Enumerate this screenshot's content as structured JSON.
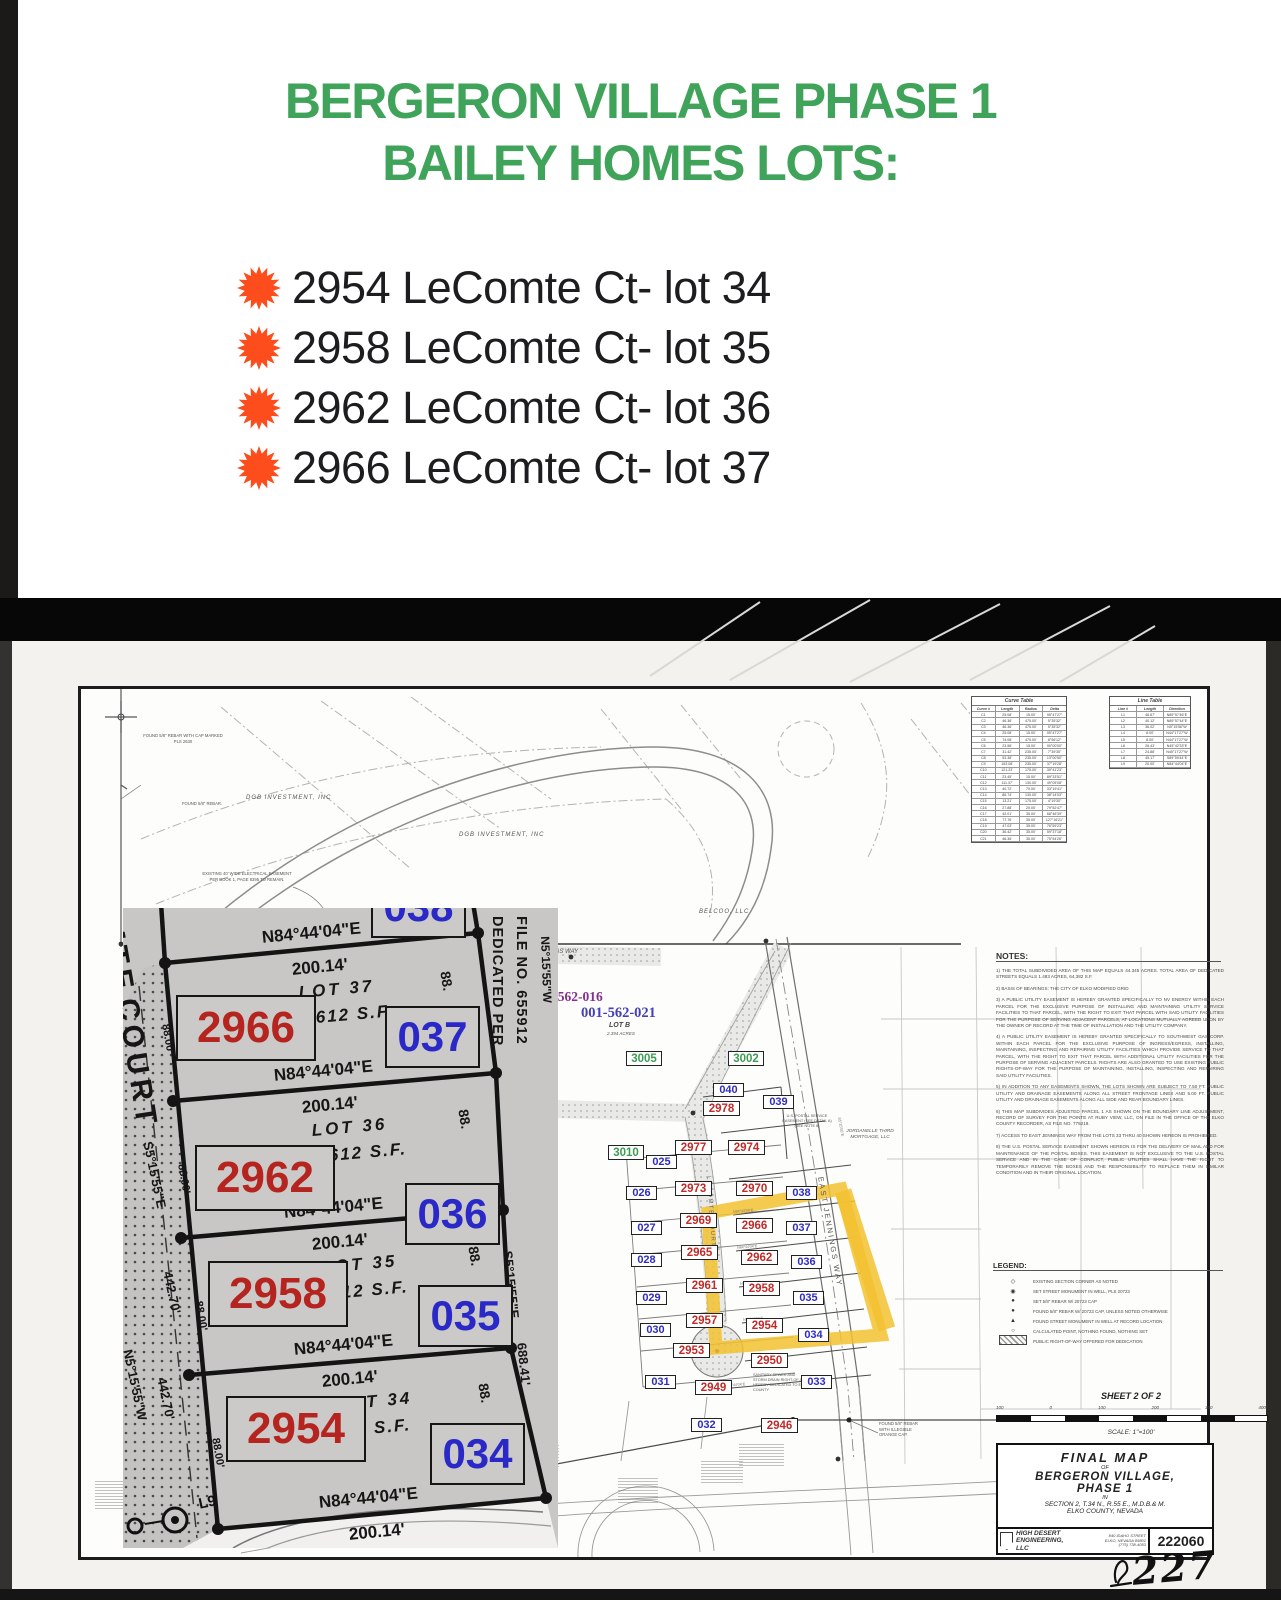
{
  "flyer": {
    "title_line1": "BERGERON VILLAGE PHASE 1",
    "title_line2": "BAILEY HOMES LOTS:",
    "accent_green": "#3fa35a",
    "bullet_color": "#fe4d1d",
    "items": [
      "2954 LeComte Ct- lot 34",
      "2958 LeComte Ct- lot 35",
      "2962 LeComte Ct- lot 36",
      "2966 LeComte Ct- lot 37"
    ]
  },
  "map": {
    "labels": {
      "dgb": "DGB INVESTMENT, INC",
      "belco": "BELCOO, LLC",
      "jordanelle1": "JORDANELLE THIRD",
      "jordanelle2": "MORTGAGE, LLC",
      "jennings_way": "JENNINGS WAY",
      "east_jennings": "EAST JENNINGS WAY",
      "lecomte_court": "LECOMTE COURT",
      "apn1": "001-562-016",
      "apn2": "001-562-021",
      "lot_b": "LOT B",
      "lot_b_area": "2.394 ACRES",
      "easement": "EXISTING 40' WIDE ELECTRICAL EASEMENT PER BOOK 1, PAGE 8395 TO REMAIN.",
      "found_cap": "FOUND 5/8\" REBAR WITH CAP MARKED PLS 2630",
      "found_rebar": "FOUND 5/8\" REBAR.",
      "found_orange": "FOUND 5/8\" REBAR WITH ILLEGIBLE ORANGE CAP.",
      "postal": "U.S. POSTAL SERVICE EASEMENT (SEE DETAIL A) (SEE NOTE 8)",
      "sanitary": "SANITARY SEWER AND STORM DRAIN RIGHT-OF-WAY HEREBY DEDICATED TO ELKO COUNTY"
    },
    "plat": {
      "red": [
        "2978",
        "2977",
        "2974",
        "2973",
        "2970",
        "2969",
        "2966",
        "2965",
        "2962",
        "2961",
        "2958",
        "2957",
        "2954",
        "2953",
        "2950",
        "2949",
        "2946"
      ],
      "blue": [
        "040",
        "039",
        "038",
        "037",
        "036",
        "035",
        "034",
        "033",
        "032",
        "031",
        "030",
        "029",
        "028",
        "027",
        "026",
        "025"
      ],
      "green": [
        "3005",
        "3002",
        "3010"
      ]
    },
    "curve_table": {
      "title": "Curve Table",
      "headers": [
        "Curve #",
        "Length",
        "Radius",
        "Delta"
      ],
      "rows": [
        [
          "C1",
          "25.08'",
          "15.00'",
          "95°47'27\""
        ],
        [
          "C2",
          "46.36'",
          "475.00'",
          "5°35'32\""
        ],
        [
          "C3",
          "46.36'",
          "475.00'",
          "5°35'32\""
        ],
        [
          "C4",
          "25.08'",
          "15.00'",
          "95°47'27\""
        ],
        [
          "C5",
          "74.08'",
          "475.00'",
          "8°56'12\""
        ],
        [
          "C6",
          "23.56'",
          "15.00'",
          "90°00'00\""
        ],
        [
          "C7",
          "31.42'",
          "235.00'",
          "7°39'35\""
        ],
        [
          "C8",
          "53.38'",
          "235.00'",
          "13°00'50\""
        ],
        [
          "C9",
          "153.08'",
          "235.00'",
          "37°19'28\""
        ],
        [
          "C10",
          "121.23'",
          "175.00'",
          "39°41'23\""
        ],
        [
          "C11",
          "23.45'",
          "15.00'",
          "89°33'51\""
        ],
        [
          "C12",
          "111.37'",
          "130.00'",
          "49°05'08\""
        ],
        [
          "C13",
          "40.72'",
          "70.00'",
          "33°19'41\""
        ],
        [
          "C14",
          "86.74'",
          "130.00'",
          "38°14'03\""
        ],
        [
          "C15",
          "13.21'",
          "175.00'",
          "4°19'30\""
        ],
        [
          "C16",
          "27.88'",
          "20.00'",
          "79°52'47\""
        ],
        [
          "C17",
          "42.01'",
          "35.00'",
          "68°46'39\""
        ],
        [
          "C18",
          "77.76'",
          "35.00'",
          "127°16'21\""
        ],
        [
          "C19",
          "47.03'",
          "35.00'",
          "76°59'23\""
        ],
        [
          "C20",
          "36.42'",
          "35.00'",
          "59°37'18\""
        ],
        [
          "C21",
          "46.36'",
          "35.00'",
          "75°54'26\""
        ]
      ]
    },
    "line_table": {
      "title": "Line Table",
      "headers": [
        "Line #",
        "Length",
        "Direction"
      ],
      "rows": [
        [
          "L1",
          "46.67'",
          "N89°57'46\"E"
        ],
        [
          "L2",
          "40.12'",
          "N89°57'44\"E"
        ],
        [
          "L3",
          "36.02'",
          "N5°15'56\"W"
        ],
        [
          "L4",
          "8.00'",
          "N44°17'27\"W"
        ],
        [
          "L5",
          "8.00'",
          "N44°17'27\"W"
        ],
        [
          "L6",
          "26.43'",
          "N45°42'33\"E"
        ],
        [
          "L7",
          "24.88'",
          "N45°17'27\"W"
        ],
        [
          "L8",
          "45.17'",
          "S89°59'44\"E"
        ],
        [
          "L9",
          "20.00'",
          "N84°44'04\"E"
        ]
      ]
    },
    "notes": {
      "heading": "NOTES:",
      "items": [
        "1) THE TOTAL SUBDIVIDED AREA OF THIS MAP EQUALS 44.345 ACRES. TOTAL AREA OF DEDICATED STREETS EQUALS 1.483 ACRES, 64,382 S.F.",
        "2) BASIS OF BEARINGS: THE CITY OF ELKO MODIFIED GRID",
        "3) A PUBLIC UTILITY EASEMENT IS HEREBY GRANTED SPECIFICALLY TO NV ENERGY WITHIN EACH PARCEL FOR THE EXCLUSIVE PURPOSE OF INSTALLING AND MAINTAINING UTILITY SERVICE FACILITIES TO THAT PARCEL, WITH THE RIGHT TO EXIT THAT PARCEL WITH SAID UTILITY FACILITIES FOR THE PURPOSE OF SERVING ADJACENT PARCELS, AT LOCATIONS MUTUALLY AGREED UPON BY THE OWNER OF RECORD AT THE TIME OF INSTALLATION AND THE UTILITY COMPANY.",
        "4) A PUBLIC UTILITY EASEMENT IS HEREBY GRANTED SPECIFICALLY TO SOUTHWEST GAS CORP. WITHIN EACH PARCEL FOR THE EXCLUSIVE PURPOSE OF INGRESS/EGRESS, INSTALLING, MAINTAINING, INSPECTING AND REPAIRING UTILITY FACILITIES WHICH PROVIDE SERVICE TO THAT PARCEL, WITH THE RIGHT TO EXIT THAT PARCEL WITH ADDITIONAL UTILITY FACILITIES FOR THE PURPOSE OF SERVING ADJACENT PARCELS. RIGHTS ARE ALSO GRANTED TO USE EXISTING PUBLIC RIGHTS-OF-WAY FOR THE PURPOSE OF MAINTAINING, INSTALLING, INSPECTING AND REPAIRING SAID UTILITY FACILITIES.",
        "5) IN ADDITION TO ANY EASEMENTS SHOWN, THE LOTS SHOWN ARE SUBJECT TO 7.50 FT. PUBLIC UTILITY AND DRAINAGE EASEMENTS ALONG ALL STREET FRONTAGE LINES AND 5.00 FT. PUBLIC UTILITY AND DRAINAGE EASEMENTS ALONG ALL SIDE AND REAR BOUNDARY LINES.",
        "6) THIS MAP SUBDIVIDES ADJUSTED PARCEL 1 AS SHOWN ON THE BOUNDARY LINE ADJUSTMENT, RECORD OF SURVEY FOR THE POINTE AT RUBY VIEW, LLC, ON FILE IN THE OFFICE OF THE ELKO COUNTY RECORDER, AS FILE NO. 775219.",
        "7) ACCESS TO EAST JENNINGS WAY FROM THE LOTS 33 THRU 40 SHOWN HEREON IS PROHIBITED.",
        "8) THE U.S. POSTAL SERVICE EASEMENT SHOWN HEREON IS FOR THE DELIVERY OF MAIL AND FOR MAINTENANCE OF THE POSTAL BOXES. THIS EASEMENT IS NOT EXCLUSIVE TO THE U.S. POSTAL SERVICE AND IN THE CASE OF CONFLICT, PUBLIC UTILITIES SHALL HAVE THE RIGHT TO TEMPORARILY REMOVE THE BOXES AND THE RESPONSIBILITY TO REPLACE THEM IN SIMILAR CONDITION AND IN THEIR ORIGINAL LOCATION."
      ]
    },
    "legend": {
      "heading": "LEGEND:",
      "items": [
        {
          "sym": "◇",
          "label": "EXISTING SECTION CORNER AS NOTED"
        },
        {
          "sym": "◉",
          "label": "SET STREET MONUMENT IN WELL, PLS 20723"
        },
        {
          "sym": "●",
          "label": "SET 5/8\" REBAR W/ 20723 CAP"
        },
        {
          "sym": "●",
          "label": "FOUND 5/8\" REBAR W/ 20723 CAP, UNLESS NOTED OTHERWISE"
        },
        {
          "sym": "▲",
          "label": "FOUND STREET MONUMENT IN WELL AT RECORD LOCATION"
        },
        {
          "sym": "○",
          "label": "CALCULATED POINT, NOTHING FOUND, NOTHING SET"
        }
      ],
      "hatch_label": "PUBLIC RIGHT-OF-WAY OFFERED FOR DEDICATION"
    },
    "sheet_info": {
      "sheet_label": "SHEET 2 OF 2",
      "scale_ticks": [
        "100",
        "0",
        "100",
        "200",
        "300",
        "400"
      ],
      "scale_label": "SCALE: 1\"=100'"
    },
    "title_block": {
      "line1": "FINAL MAP",
      "line2": "OF",
      "line3": "BERGERON VILLAGE,",
      "line4": "PHASE 1",
      "line5": "IN",
      "line6": "SECTION 2, T.34 N., R.55 E., M.D.B.& M.",
      "line7": "ELKO COUNTY, NEVADA",
      "firm_name1": "HIGH DESERT",
      "firm_name2": "ENGINEERING,",
      "firm_name3": "LLC",
      "addr1": "840 IDAHO STREET",
      "addr2": "ELKO, NEVADA 89801",
      "addr3": "(775) 738-4053",
      "job_number": "222060",
      "handwritten": "227"
    },
    "inset": {
      "addresses": [
        "2966",
        "2962",
        "2958",
        "2954"
      ],
      "lot_numbers": [
        "037",
        "036",
        "035",
        "034"
      ],
      "lot_names": [
        "LOT 37",
        "LOT 36",
        "LOT 35",
        "LOT 34"
      ],
      "lot_sf": [
        "612 S.F.",
        "612 S.F.",
        "12 S.F.",
        "2 S.F."
      ],
      "clipped_lot": "038",
      "street_frag1": "MTE",
      "street_frag2": "COURT",
      "bearing": "N84°44'04\"E",
      "dist": "200.14'",
      "s5e": "S5°15'55\"E",
      "n5w": "N5°15'55\"W",
      "d442": "442.70'",
      "d688": "688.41'",
      "d88": "88.",
      "d8800": "88.00'",
      "dedicated1": "DEDICATED PER",
      "dedicated2": "FILE NO. 655912",
      "l9": "L9"
    }
  }
}
